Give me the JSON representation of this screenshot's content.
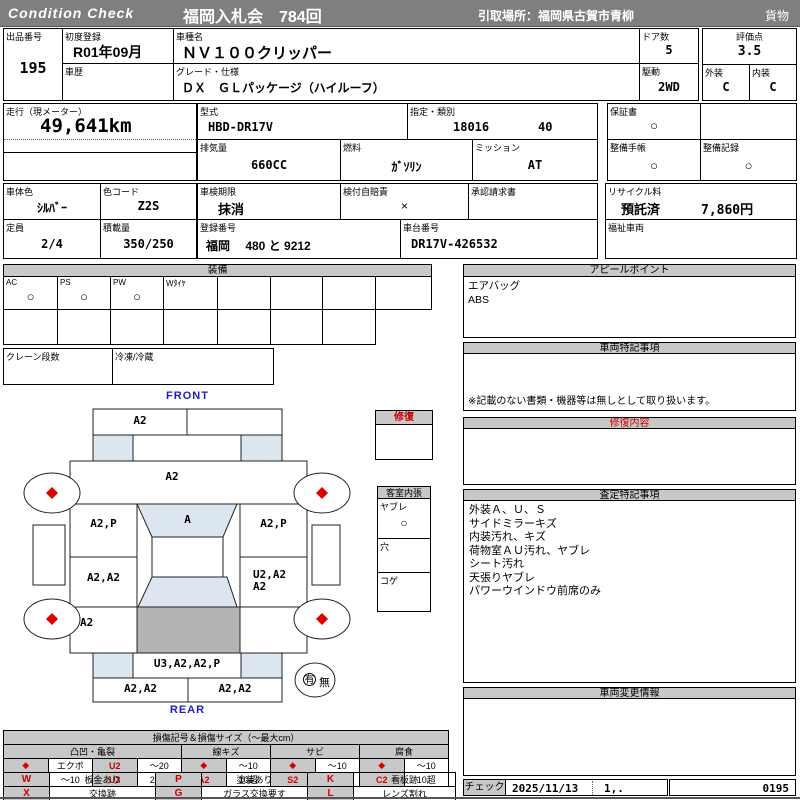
{
  "header": {
    "brand": "Condition  Check",
    "auction": "福岡入札会　784回",
    "pickup": "引取場所：福岡県古賀市青柳",
    "category": "貨物"
  },
  "info": {
    "exhibit": {
      "label": "出品番号",
      "value": "195"
    },
    "first_reg": {
      "label": "初度登録",
      "value": "R01年09月"
    },
    "history": {
      "label": "車歴",
      "value": ""
    },
    "model_name": {
      "label": "車種名",
      "value": "ＮＶ１００クリッパー"
    },
    "grade": {
      "label": "グレード・仕様",
      "value": "ＤＸ　ＧＬパッケージ（ハイルーフ）"
    },
    "doors": {
      "label": "ドア数",
      "value": "5"
    },
    "drive": {
      "label": "駆動",
      "value": "2WD"
    },
    "score": {
      "label": "評価点",
      "value": "3.5"
    },
    "exterior": {
      "label": "外装",
      "value": "C"
    },
    "interior": {
      "label": "内装",
      "value": "C"
    },
    "mileage": {
      "label": "走行（現メーター）",
      "value": "49,641km"
    },
    "model_code": {
      "label": "型式",
      "value": "HBD-DR17V"
    },
    "class": {
      "label": "指定・類別",
      "value1": "18016",
      "value2": "40"
    },
    "displacement": {
      "label": "排気量",
      "value": "660CC"
    },
    "fuel": {
      "label": "燃料",
      "value": "ｶﾞｿﾘﾝ"
    },
    "mission": {
      "label": "ミッション",
      "value": "AT"
    },
    "warranty": {
      "label": "保証書",
      "value": "○"
    },
    "maint_book": {
      "label": "整備手帳",
      "value": "○"
    },
    "maint_rec": {
      "label": "整備記録",
      "value": "○"
    },
    "body_color": {
      "label": "車体色",
      "value": "ｼﾙﾊﾞｰ"
    },
    "color_code": {
      "label": "色コード",
      "value": "Z2S"
    },
    "inspection": {
      "label": "車検期限",
      "value": "抹消"
    },
    "jibai": {
      "label": "検付自賠責",
      "value": "×"
    },
    "approval": {
      "label": "承認請求書",
      "value": ""
    },
    "capacity": {
      "label": "定員",
      "value": "2/4"
    },
    "load": {
      "label": "積載量",
      "value": "350/250"
    },
    "reg_no": {
      "label": "登録番号",
      "value": "福岡　 480 と 9212"
    },
    "chassis": {
      "label": "車台番号",
      "value": "DR17V-426532"
    },
    "recycle": {
      "label": "リサイクル料",
      "status": "預託済",
      "fee": "7,860円"
    },
    "welfare": {
      "label": "福祉車両",
      "value": ""
    }
  },
  "equipment": {
    "title": "装備",
    "items": [
      {
        "label": "AC",
        "value": "○"
      },
      {
        "label": "PS",
        "value": "○"
      },
      {
        "label": "PW",
        "value": "○"
      },
      {
        "label": "Wﾀｲﾔ",
        "value": ""
      },
      {
        "label": "",
        "value": ""
      },
      {
        "label": "",
        "value": ""
      },
      {
        "label": "",
        "value": ""
      },
      {
        "label": "",
        "value": ""
      }
    ],
    "crane_label": "クレーン段数",
    "fridge_label": "冷凍/冷蔵"
  },
  "appeal": {
    "title": "アピールポイント",
    "lines": [
      "エアバッグ",
      "ABS"
    ]
  },
  "vehicle_notes": {
    "title": "車両特記事項",
    "footnote": "※記載のない書類・機器等は無しとして取り扱います。"
  },
  "repair_box": {
    "title": "修復"
  },
  "cabin": {
    "title": "客室内張",
    "items": [
      {
        "label": "ヤブレ",
        "value": "○"
      },
      {
        "label": "穴",
        "value": ""
      },
      {
        "label": "コゲ",
        "value": ""
      }
    ]
  },
  "repair_content": {
    "title": "修復内容"
  },
  "assessment": {
    "title": "査定特記事項",
    "lines": [
      "外装Ａ、Ｕ、Ｓ",
      "サイドミラーキズ",
      "内装汚れ、キズ",
      "荷物室ＡＵ汚れ、ヤブレ",
      "シート汚れ",
      "天張りヤブレ",
      "パワーウインドウ前席のみ"
    ]
  },
  "change_info": {
    "title": "車両変更情報"
  },
  "check": {
    "label": "チェック",
    "date": "2025/11/13",
    "code": "1,.",
    "number": "0195"
  },
  "diagram": {
    "front": "FRONT",
    "rear": "REAR",
    "front_bumper": "A2",
    "hood": "A2",
    "windshield": "A",
    "front_door_left": "A2,P",
    "front_door_right": "A2,P",
    "rear_door_left": "A2,A2",
    "rear_door_right_1": "U2,A2",
    "rear_door_right_2": "A2",
    "quarter_left": "A2",
    "back_panel": "U3,A2,A2,P",
    "rear_bumper_left": "A2,A2",
    "rear_bumper_right": "A2,A2",
    "spare_yes": "有",
    "spare_no": "無"
  },
  "legend": {
    "title": "損傷記号＆損傷サイズ（～最大cm）",
    "groups": [
      "凸凹・亀裂",
      "線キズ",
      "サビ",
      "腐食"
    ],
    "rows": [
      [
        "◆",
        "エクボ",
        "U2",
        "～20",
        "◆",
        "～10",
        "◆",
        "～10",
        "◆",
        "～10"
      ],
      [
        "◆",
        "～10",
        "U3",
        "20超",
        "A2",
        "10超",
        "S2",
        "10超",
        "C2",
        "10超"
      ]
    ],
    "marks": [
      [
        "W",
        "板金あり",
        "P",
        "塗装あり",
        "K",
        "看板跡"
      ],
      [
        "X",
        "交換跡",
        "G",
        "ガラス交換要す",
        "L",
        "レンズ割れ"
      ]
    ]
  },
  "colors": {
    "accent_red": "#cc0000",
    "header_gray": "#7f7f7f",
    "panel_gray": "#c8c8c8",
    "glass_blue": "#dce6f1",
    "roof_gray": "#b3b3b3",
    "label_blue": "#2020c0"
  }
}
